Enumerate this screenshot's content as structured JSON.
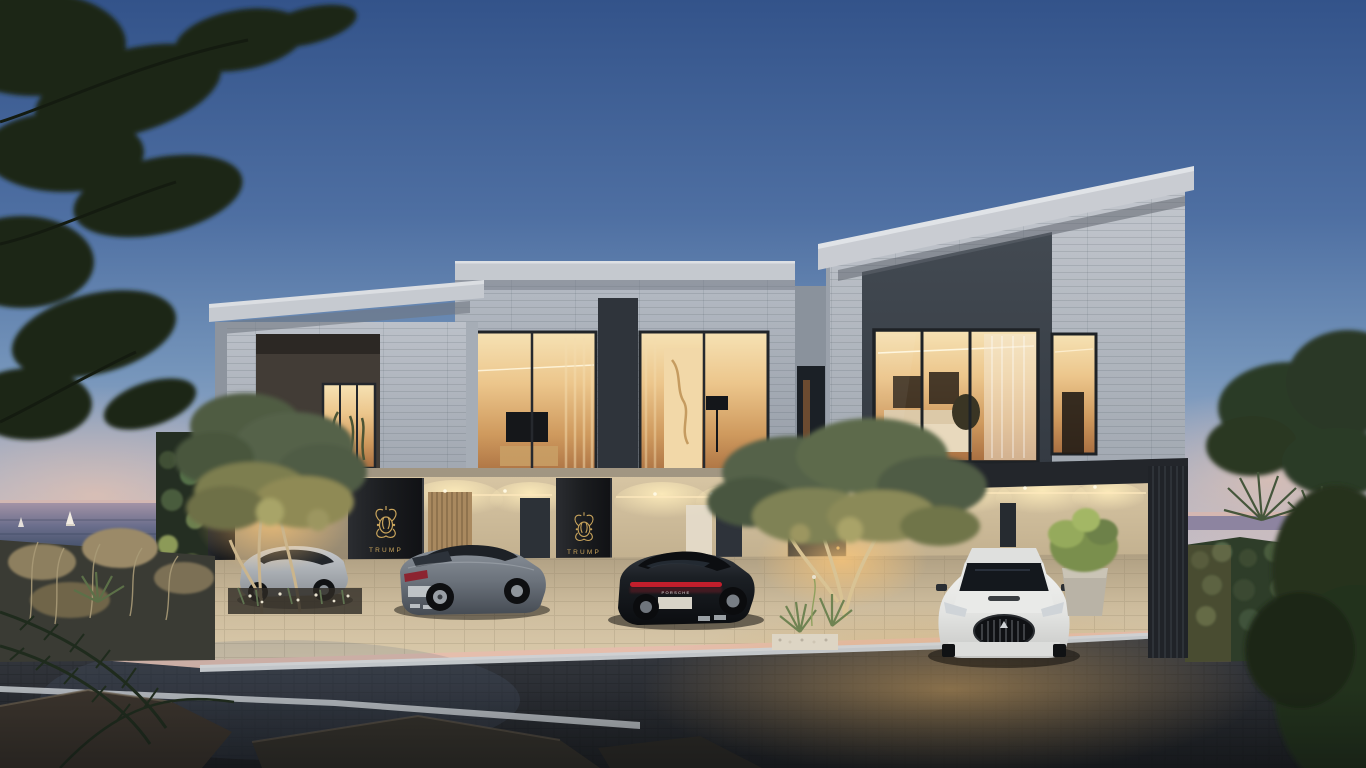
{
  "scene": {
    "type": "architectural-render",
    "title": "Luxury seafront townhouses at dusk",
    "branding": {
      "crest_label": "TRUMP",
      "crest_color": "#c9a45c",
      "crest_locations": [
        "carport-pillar-left",
        "carport-pillar-center"
      ]
    },
    "cars": [
      {
        "name": "silver-coupe",
        "position": "carport-1",
        "color": "#b8bcc1"
      },
      {
        "name": "grey-coupe",
        "position": "carport-2",
        "color": "#6e757e"
      },
      {
        "name": "black-sports-car",
        "position": "carport-3",
        "color": "#15171b",
        "badge": "PORSCHE",
        "taillight_color": "#c21f2c"
      },
      {
        "name": "white-grand-tourer",
        "position": "carport-4",
        "color": "#e9eae8"
      }
    ],
    "environment": {
      "sky_top": "#33538a",
      "sky_mid": "#7e9ac0",
      "horizon_pink": "#e8c0b0",
      "sea_visible": true,
      "sailboats": 2,
      "lit_interiors": 5,
      "street_surface_color": "#2b2e34",
      "curb_color": "#cdd1d5",
      "lighting": "warm interior glow and landscape uplights at twilight"
    },
    "architecture": {
      "style": "modern minimalist",
      "units_visible": 3,
      "stone_color": "#b6bcc4",
      "panel_color": "#3b4149",
      "window_glow": "#eccb92",
      "ground_wall_color": "#d0bd9c"
    }
  }
}
